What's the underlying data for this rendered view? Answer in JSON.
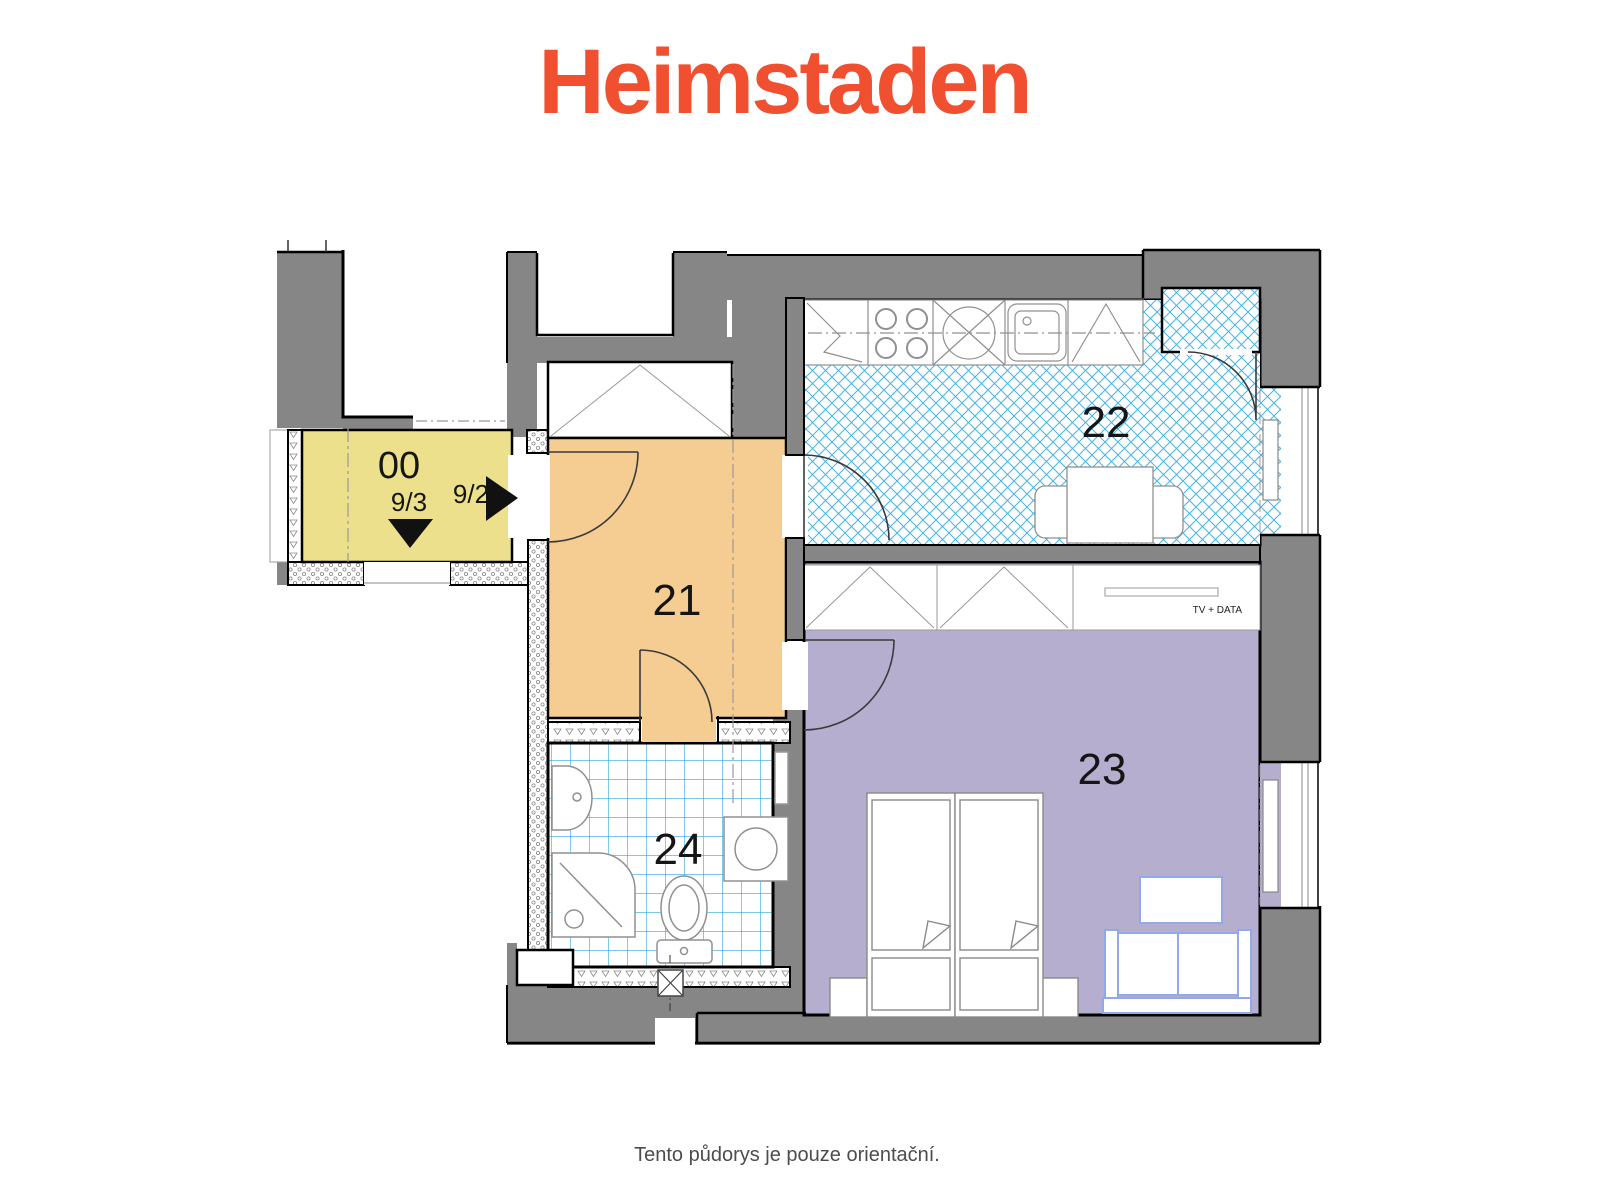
{
  "logo": {
    "text": "Heimstaden",
    "color": "#F0502F"
  },
  "caption": "Tento půdorys je pouze orientační.",
  "rooms": {
    "entry": {
      "number": "00",
      "flat_left": "9/3",
      "flat_right": "9/2",
      "color": "#EDE08C"
    },
    "hall": {
      "number": "21",
      "color": "#F5CD92"
    },
    "kitchen": {
      "number": "22",
      "hatch_color": "#45B5E6"
    },
    "living": {
      "number": "23",
      "color": "#B5AECF",
      "tv_label": "TV + DATA"
    },
    "bathroom": {
      "number": "24",
      "tile_color": "#2FA8DF"
    }
  },
  "colors": {
    "wall": "#868686",
    "outline": "#000000",
    "furniture_line": "#909090",
    "door_line": "#3a3a3a",
    "sofa_line": "#8FA9EA",
    "label": "#151515"
  }
}
